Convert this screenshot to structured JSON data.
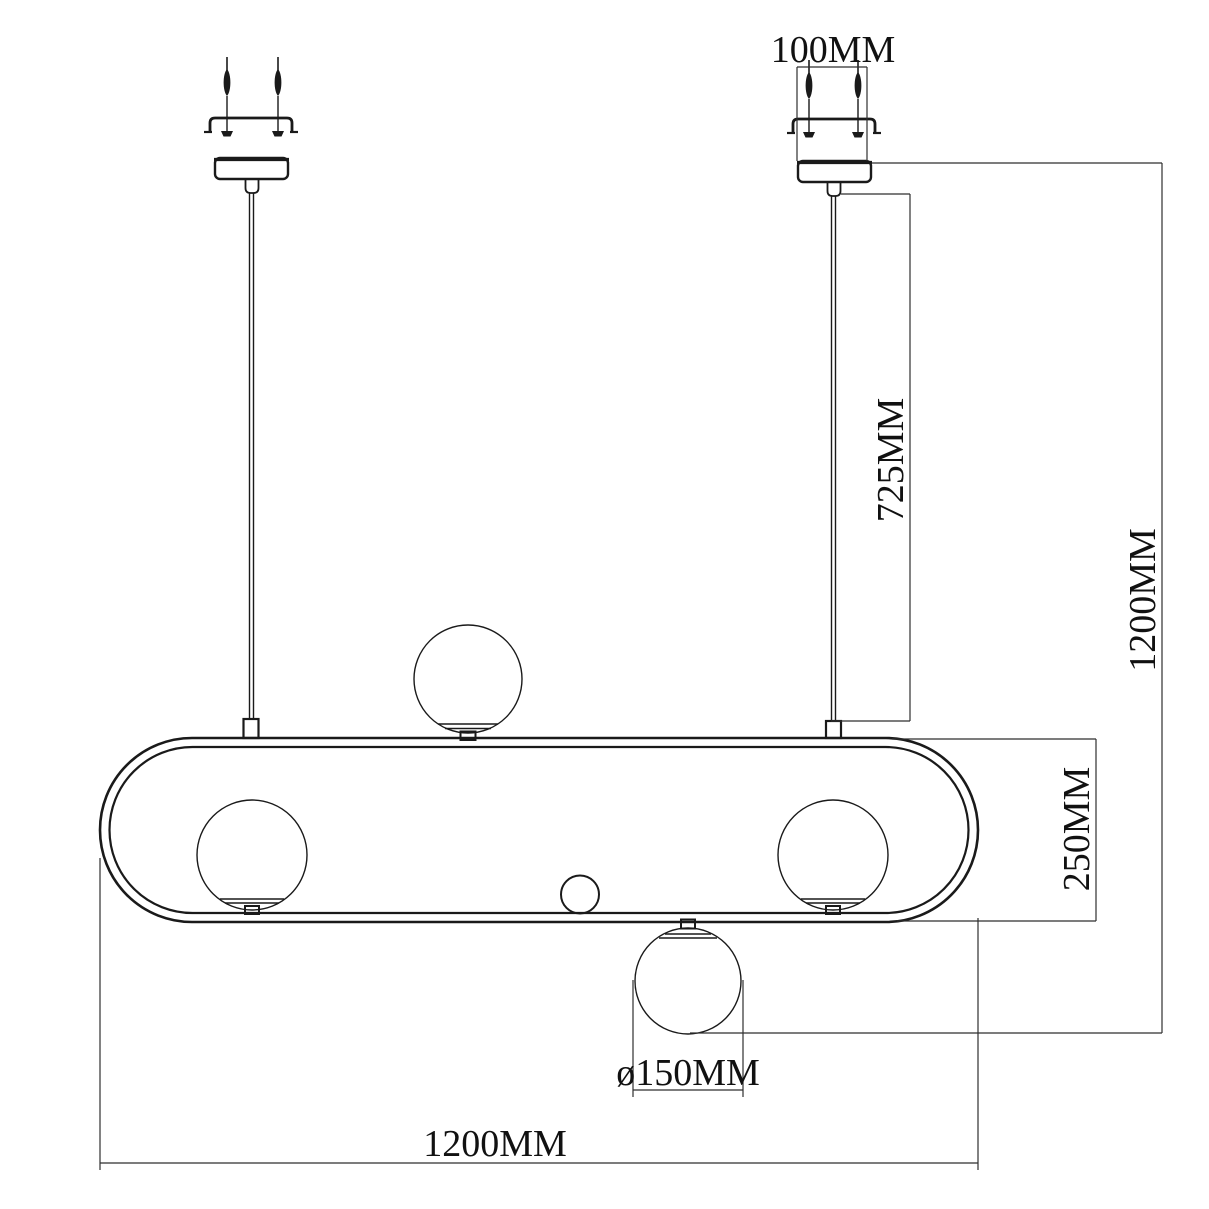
{
  "page": {
    "background": "#ffffff",
    "line_color": "#1a1a1a",
    "dim_line_color": "#2f2f2f",
    "text_color": "#111111"
  },
  "dimensions": {
    "canopy_width": "100MM",
    "rod_length": "725MM",
    "overall_height": "1200MM",
    "frame_height": "250MM",
    "globe_diameter": "ø150MM",
    "overall_width": "1200MM"
  }
}
